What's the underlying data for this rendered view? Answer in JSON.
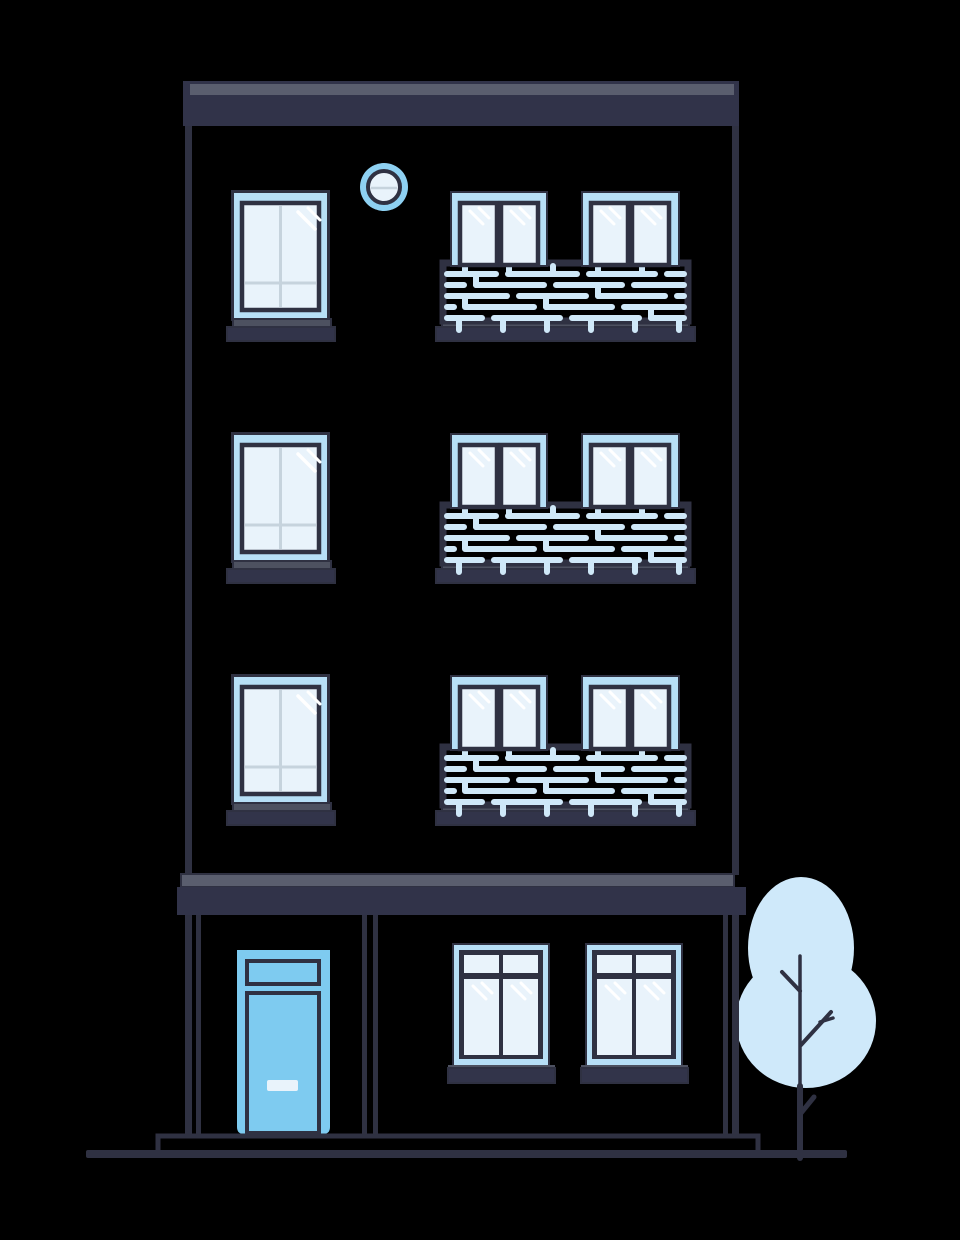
{
  "illustration": {
    "subject": "apartment-building-with-tree",
    "style": "flat-vector",
    "floors": 3,
    "side_windows": 3,
    "porthole_windows": 1,
    "balconies": 3,
    "balcony_windows_per_balcony": 2,
    "ground_floor": {
      "doors": 1,
      "windows": 2
    },
    "trees": 1
  },
  "palette": {
    "background": "#000000",
    "outline": "#2f3142",
    "facade_band": "#313349",
    "band_highlight": "#5a5e6e",
    "sill": "#32344a",
    "sill_highlight": "#4d5160",
    "window_frame": "#b7dff6",
    "glass": "#e9f3fb",
    "glass_mullion": "#c6d3dd",
    "glare": "#ffffff",
    "door": "#7ecbf0",
    "door_handle": "#e9f3fb",
    "porthole_ring": "#8ed1f2",
    "railing": "#cfe8f8",
    "tree_foliage": "#cfe9fa"
  }
}
